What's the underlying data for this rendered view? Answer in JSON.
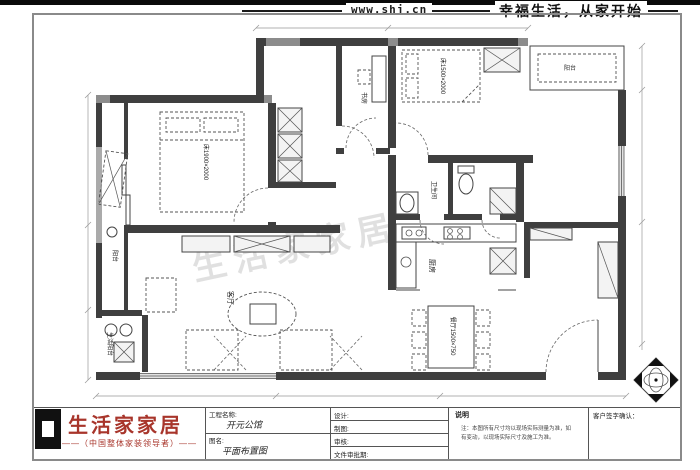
{
  "header": {
    "website": "www.shj.cn",
    "slogan": "幸福生活，从家开始"
  },
  "logo": {
    "brand": "生活家家居",
    "tagline": "——（中国整体家装领导者）——",
    "brand_color": "#a8352b"
  },
  "title_block": {
    "project_label": "工程名称:",
    "project_value": "开元公馆",
    "drawing_label": "图名:",
    "drawing_value": "平面布置图",
    "fields": [
      {
        "label": "设计:"
      },
      {
        "label": "制图:"
      },
      {
        "label": "审核:"
      },
      {
        "label": "文件审批期:"
      }
    ],
    "note_title": "说明",
    "note_line1": "注：本图所有尺寸均以现场实际测量为准，如",
    "note_line2": "有变动，以现场实际尺寸及施工为准。",
    "sign_label": "客户签字确认："
  },
  "plan": {
    "watermark": "生活家家居",
    "rooms": {
      "master_bed": "床1900×2000",
      "second_bed": "床1500×2000",
      "dining": "餐厅1500×750",
      "kitchen": "厨房",
      "bathroom": "卫生间",
      "living": "客厅",
      "study": "书房",
      "balcony_left": "阳台",
      "balcony_top": "阳台",
      "utility": "生活阳台"
    }
  }
}
